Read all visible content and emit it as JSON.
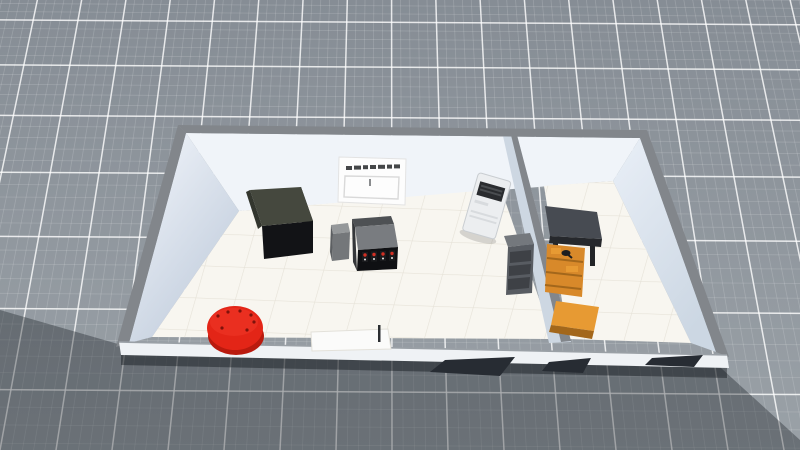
{
  "scene": {
    "type": "3d-simulation-viewport",
    "description_names": {
      "ground": "infinite-grid-ground",
      "building": "two-room-building",
      "cabinet": "dark-storage-cabinet",
      "stove": "kitchen-stove",
      "side_cabinet": "small-gray-cabinet",
      "wall_poster": "whiteboard-poster",
      "vending_machine": "white-vending-machine",
      "drawer_cabinet": "gray-drawer-cabinet",
      "work_table": "dark-work-table",
      "workbench": "orange-workbench-shelves",
      "front_table": "white-low-table",
      "red_stool": "red-round-stool",
      "door_openings": "dark-doorway-openings"
    }
  },
  "colors": {
    "ground_top": "#868d95",
    "ground_bottom": "#9aa1a7",
    "grid_major": "rgba(255,255,255,0.8)",
    "grid_minor": "rgba(255,255,255,0.16)",
    "shadow": "rgba(15,20,27,0.34)",
    "contact_shadow": "rgba(10,14,18,0.42)",
    "wall_top_edge": "#82868b",
    "wall_back": "#f0f4f9",
    "wall_left_light": "#f4f7fc",
    "wall_left_shade": "#bfcbdb",
    "wall_right_light": "#e9eff7",
    "wall_right_shade": "#ccd7e3",
    "divider_face": "#cdd7e2",
    "floor_base": "#f8f6f0",
    "floor_line": "#e6e2d8",
    "front_band": "#eff2f5",
    "front_band_edge": "#9aa0a6",
    "door_opening": "#272c33",
    "cabinet_top": "#45483e",
    "cabinet_side": "#0c0d0f",
    "cabinet_front": "#121316",
    "stove_back": "#4e5154",
    "stove_top": "#797c80",
    "stove_front": "#0f1013",
    "stove_side": "#35373a",
    "knob_dark": "#1a1b1e",
    "knob_red": "#d22f23",
    "knob_white": "#e8e8e8",
    "side_cab_top": "#95989a",
    "side_cab_front": "#74777a",
    "side_cab_side": "#5c5f62",
    "fridge_body": "#eceef0",
    "fridge_edge": "#c9cdd1",
    "fridge_panel": "#2a2c2f",
    "fridge_slat": "#4a4d50",
    "fridge_vent": "#d8dbde",
    "drawer_top": "#74787d",
    "drawer_front": "#585c62",
    "drawer_slat": "#3e4146",
    "table_top": "#474b52",
    "table_edge": "#26282c",
    "table_leg": "#222427",
    "bench_orange": "#d8892a",
    "bench_orange_light": "#e79a33",
    "bench_orange_dark": "#a3671b",
    "bench_item_dark": "#1d1e20",
    "pouf_red": "#e32517",
    "pouf_red_light": "#ea2f20",
    "pouf_red_dark": "#b91a0e",
    "pouf_dot": "#7e120b",
    "board_bg": "#fdfdfd",
    "board_edge": "#e3e3e3",
    "board_text": "#2c2e31",
    "board_outline": "#d9d9d9",
    "front_table_fill": "#fbfbfa",
    "front_table_edge": "#e3e1da",
    "stick_dark": "#2b2e31"
  }
}
